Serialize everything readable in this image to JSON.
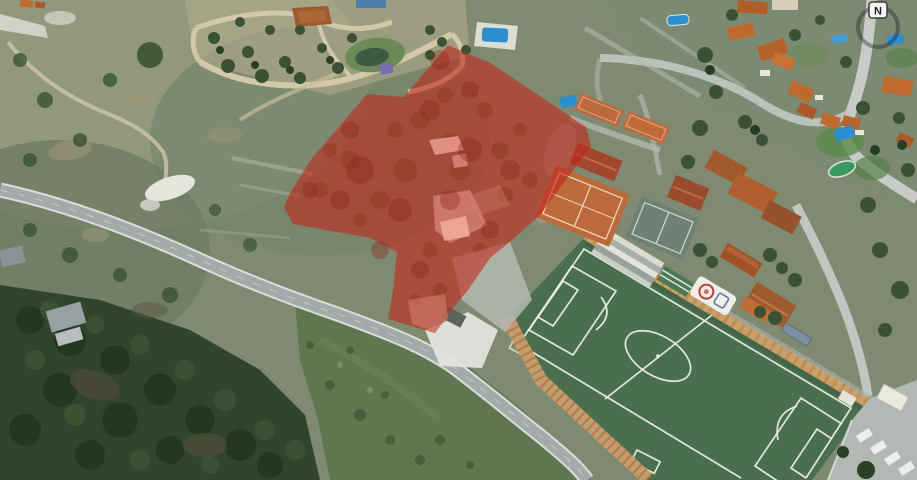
{
  "app": {
    "type": "aerial-satellite-map-view"
  },
  "compass": {
    "label": "N"
  },
  "overlay_parcel": {
    "description": "red highlighted land parcel annotation",
    "points": "448,45 490,63 586,127 591,146 540,215 512,240 490,258 468,290 450,312 435,333 388,319 393,290 397,252 370,238 293,224 284,207 290,193 312,158 333,134 367,94 404,97"
  },
  "palette": {
    "terrain": "#7f8a70",
    "terrain_light": "#969b80",
    "scrub_dark": "#6f7c63",
    "park_sand": "#b7ae8f",
    "path_tan": "#d3c9a9",
    "rock": "#e5e5dc",
    "forest": "#31452c",
    "tree": "#3a5233",
    "meadow": "#5e7751",
    "road_light": "#dadddc",
    "road_gray": "#a4aaaa",
    "field_green": "#4b6e4e",
    "field_line": "#eef2ea",
    "terrace_tan": "#c59c6b",
    "clay": "#bc6a3c",
    "clay_roof": "#a1472e",
    "hard_court": "#6e8176",
    "roof_orange": "#bf6a2d",
    "roof_dark": "#a05226",
    "wall_white": "#e9e6dc",
    "pool_blue": "#2e8fd0",
    "parking_gray": "#b3b8b5",
    "gray_roof": "#97a0a3",
    "overlay_red": "#c1271a",
    "overlay_opacity": "0.6",
    "compass_bg": "#f6f6f3",
    "compass_ink": "#1c1c1c"
  }
}
